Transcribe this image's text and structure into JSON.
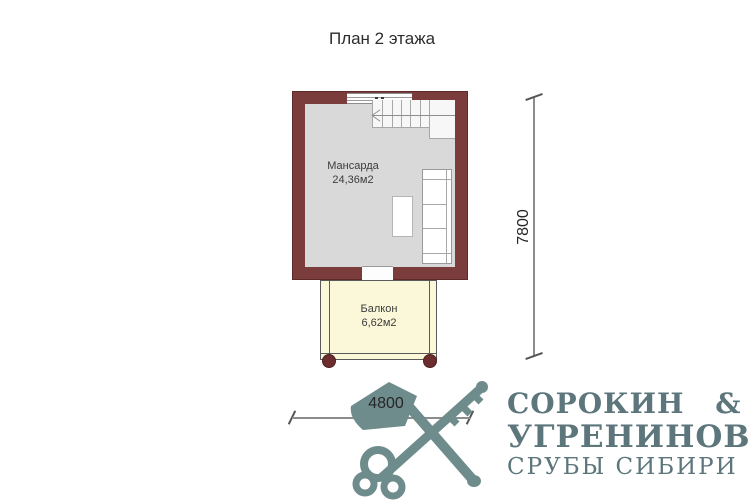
{
  "title": "План 2 этажа",
  "room": {
    "name": "Мансарда",
    "area": "24,36м2"
  },
  "balcony": {
    "name": "Балкон",
    "area": "6,62м2"
  },
  "dims": {
    "width": "4800",
    "height": "7800"
  },
  "logo": {
    "line1": "СОРОКИН &",
    "line2": "УГРЕНИНОВ",
    "line3": "СРУБЫ СИБИРИ",
    "icon": "axe-and-key-icon"
  },
  "colors": {
    "wall": "#7b3c3c",
    "floor": "#d9d9da",
    "balcony_fill": "#faf8d8",
    "post": "#6b2d2d",
    "logo": "#5c767b",
    "logo_icon": "#6f8c8c",
    "background": "#ffffff"
  }
}
